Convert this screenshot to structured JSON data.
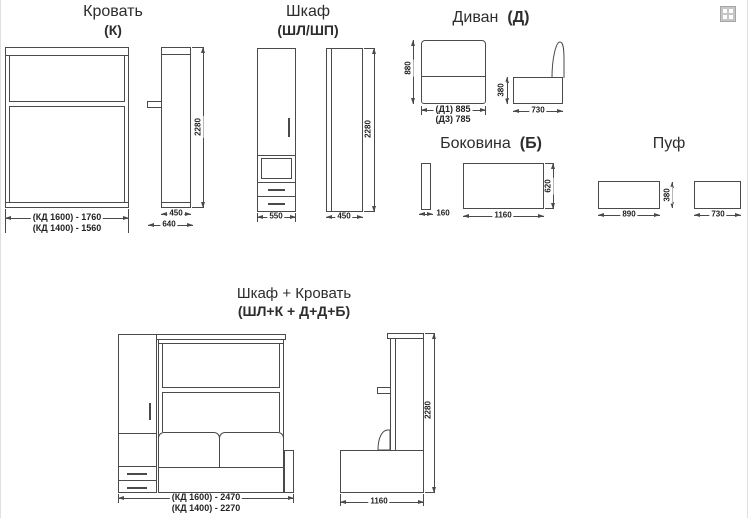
{
  "colors": {
    "line": "#4a4a4a",
    "text": "#2d2d2d",
    "bg": "#ffffff"
  },
  "corner_icon": "grid-icon",
  "bed": {
    "title": "Кровать",
    "code": "(К)",
    "dims": {
      "front_w1600": "(КД 1600) - 1760",
      "front_w1400": "(КД 1400) - 1560",
      "height": "2280",
      "side_w": "450",
      "side_total": "640"
    }
  },
  "wardrobe": {
    "title": "Шкаф",
    "code": "(ШЛ/ШП)",
    "dims": {
      "front_w": "550",
      "side_w": "450",
      "height": "2280"
    }
  },
  "sofa": {
    "title": "Диван",
    "code": "(Д)",
    "dims": {
      "height": "880",
      "w_d1": "(Д1) 885",
      "w_d3": "(Д3) 785",
      "seat_h": "380",
      "depth": "730"
    }
  },
  "sidewall": {
    "title": "Боковина",
    "code": "(Б)",
    "dims": {
      "thickness": "160",
      "length": "1160",
      "height": "620"
    }
  },
  "pouf": {
    "title": "Пуф",
    "dims": {
      "front_w": "890",
      "height": "380",
      "depth": "730"
    }
  },
  "combo": {
    "title": "Шкаф + Кровать",
    "code": "(ШЛ+К + Д+Д+Б)",
    "dims": {
      "front_w1600": "(КД 1600) - 2470",
      "front_w1400": "(КД 1400) - 2270",
      "height": "2280",
      "depth": "1160"
    }
  }
}
